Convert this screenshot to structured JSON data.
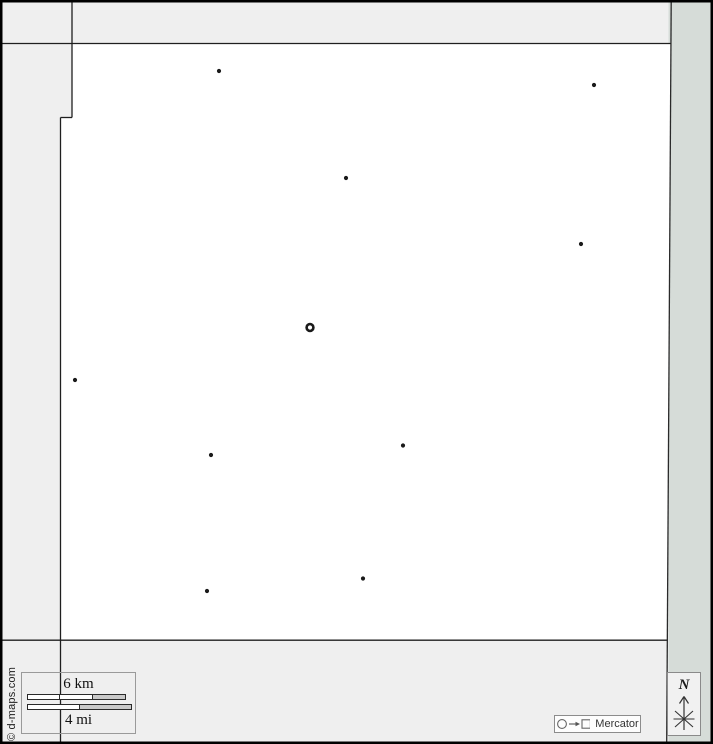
{
  "copyright": "© d-maps.com",
  "projection": {
    "label": "Mercator"
  },
  "compass": {
    "north_label": "N"
  },
  "scale": {
    "km_label": "6 km",
    "mi_label": "4 mi",
    "km_bar": {
      "left": 5,
      "top": 21,
      "width": 97,
      "height": 4,
      "segments": [
        {
          "w": 32,
          "fill": "#ffffff"
        },
        {
          "w": 32,
          "fill": "#ffffff"
        },
        {
          "w": 33,
          "fill": "#c9c9c9"
        }
      ]
    },
    "mi_bar": {
      "left": 5,
      "top": 31,
      "width": 103,
      "height": 4,
      "segments": [
        {
          "w": 51,
          "fill": "#ffffff"
        },
        {
          "w": 52,
          "fill": "#c9c9c9"
        }
      ]
    }
  },
  "map": {
    "town_radius": 2.1,
    "capital_ring": {
      "radius": 3.4,
      "stroke_width": 2.6
    },
    "markers": [
      {
        "type": "capital",
        "x": 310,
        "y": 327.5
      },
      {
        "type": "town",
        "x": 219,
        "y": 71
      },
      {
        "type": "town",
        "x": 594,
        "y": 85
      },
      {
        "type": "town",
        "x": 346,
        "y": 178
      },
      {
        "type": "town",
        "x": 581,
        "y": 244
      },
      {
        "type": "town",
        "x": 75,
        "y": 380
      },
      {
        "type": "town",
        "x": 403,
        "y": 445.5
      },
      {
        "type": "town",
        "x": 211,
        "y": 455
      },
      {
        "type": "town",
        "x": 363,
        "y": 578.5
      },
      {
        "type": "town",
        "x": 207,
        "y": 591
      }
    ]
  },
  "colors": {
    "background_gray": "#efefef",
    "map_white": "#ffffff",
    "right_margin_green": "#d6dcd8",
    "boundary_line": "#1f1f1f",
    "marker_black": "#1a1a1a",
    "frame_black": "#000000"
  }
}
